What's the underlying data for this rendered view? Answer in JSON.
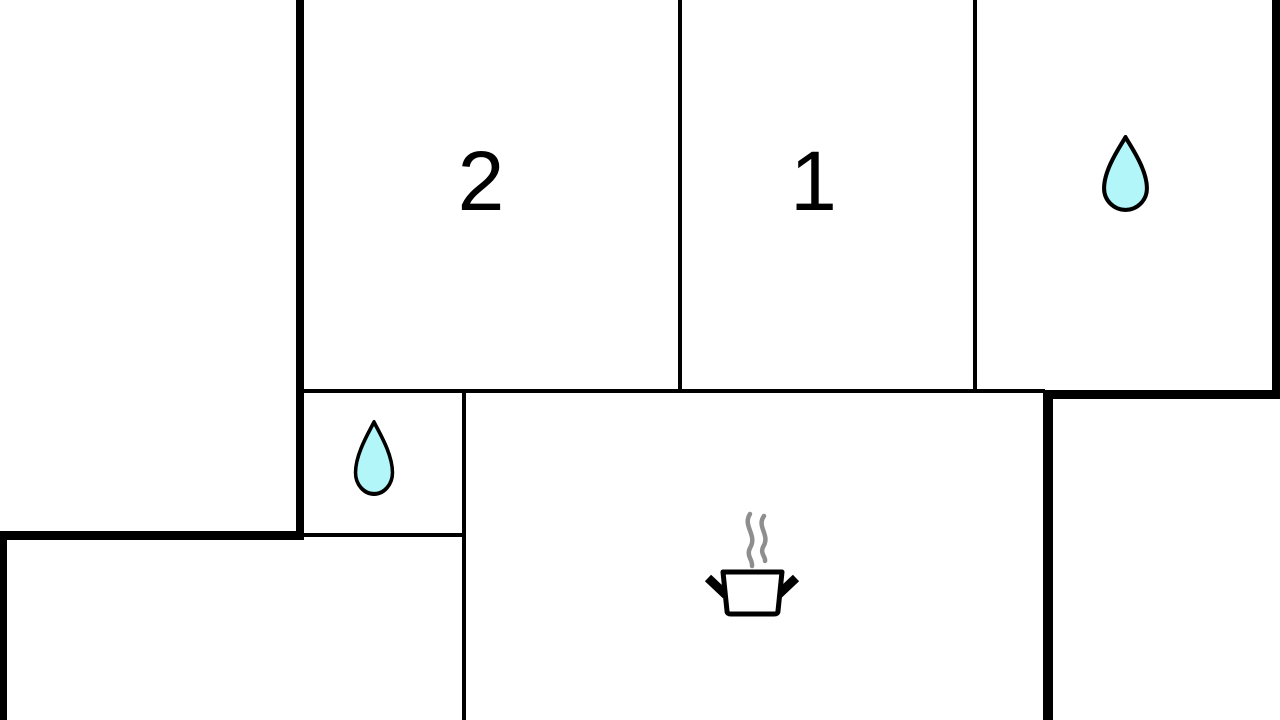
{
  "plan": {
    "name": "apartment-floor-plan",
    "rooms": {
      "bedroom2": {
        "label": "2",
        "type": "bedroom"
      },
      "bedroom1": {
        "label": "1",
        "type": "bedroom"
      },
      "bathroom_top_right": {
        "icon": "water-drop-icon",
        "type": "bathroom"
      },
      "bathroom_small": {
        "icon": "water-drop-icon",
        "type": "bathroom"
      },
      "kitchen_living": {
        "icon": "cooking-pot-icon",
        "type": "kitchen-living"
      },
      "room_bottom_left": {
        "type": "unlabeled-room"
      }
    }
  },
  "colors": {
    "background": "#ffffff",
    "wall": "#000000",
    "label_text": "#000000",
    "water_drop_fill": "#b2f6f9",
    "water_drop_outline": "#000000",
    "steam": "#8e8e8e",
    "pot_outline": "#000000"
  }
}
